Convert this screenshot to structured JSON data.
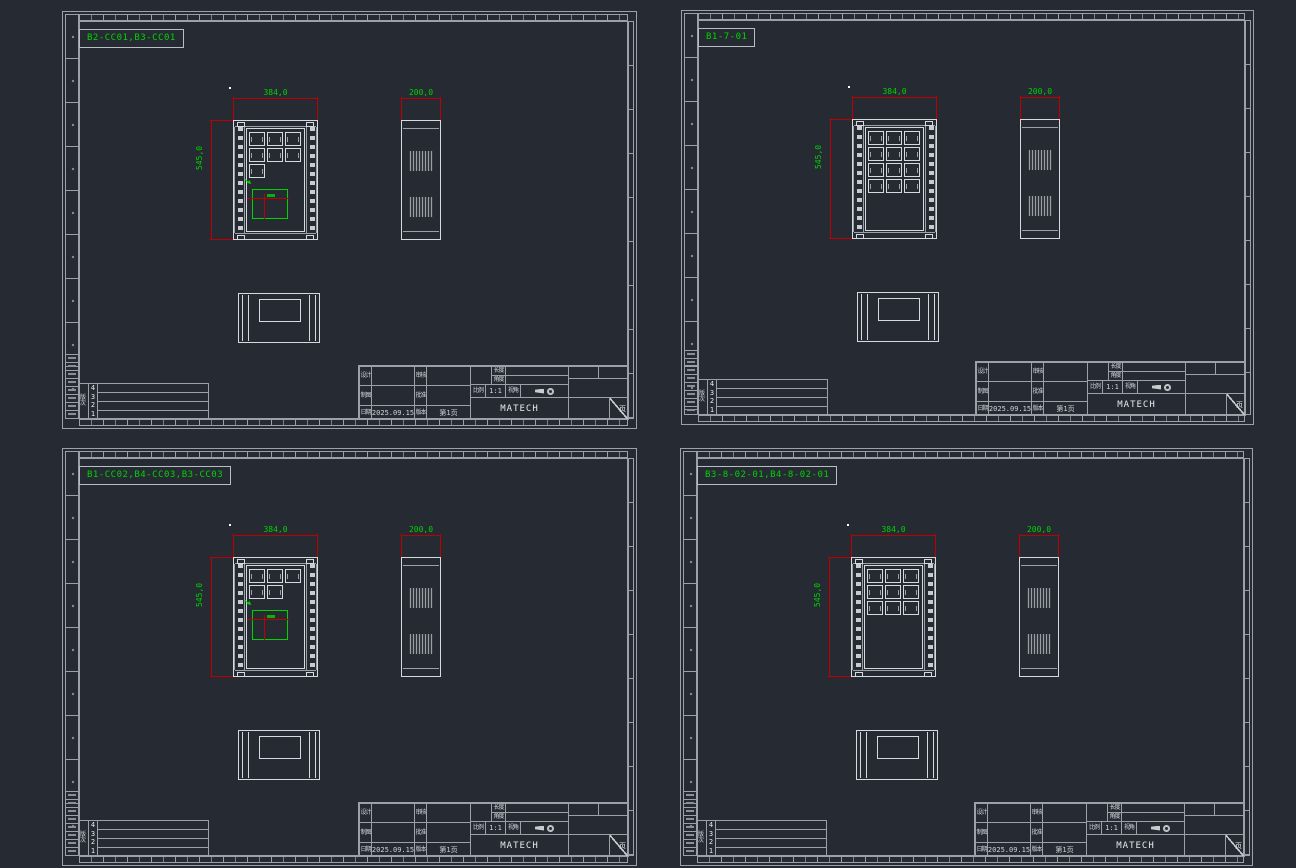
{
  "app": {
    "type": "cad-drawing-viewport",
    "colors": {
      "background": "#252a33",
      "frame_line": "#9ba1a8",
      "entity_line": "#d6dade",
      "annotation_green": "#00d400",
      "dimension_red": "#c00000"
    }
  },
  "sheets": [
    {
      "code": "B2-CC01,B3-CC01",
      "dims": {
        "front_width": "384,0",
        "front_height": "545,0",
        "side_width": "200,0"
      },
      "front": {
        "module_rows": [
          3,
          3,
          1
        ],
        "green_detail": true
      }
    },
    {
      "code": "B1-7-01",
      "dims": {
        "front_width": "384,0",
        "front_height": "545,0",
        "side_width": "200,0"
      },
      "front": {
        "module_rows": [
          3,
          3,
          3,
          3
        ],
        "green_detail": false
      }
    },
    {
      "code": "B1-CC02,B4-CC03,B3-CC03",
      "dims": {
        "front_width": "384,0",
        "front_height": "545,0",
        "side_width": "200,0"
      },
      "front": {
        "module_rows": [
          3,
          2
        ],
        "green_detail": true
      }
    },
    {
      "code": "B3-8-02-01,B4-8-02-01",
      "dims": {
        "front_width": "384,0",
        "front_height": "545,0",
        "side_width": "200,0"
      },
      "front": {
        "module_rows": [
          3,
          3,
          3
        ],
        "green_detail": false
      }
    }
  ],
  "title_block": {
    "design": "设计",
    "check": "审核",
    "draft": "制图",
    "approve": "批准",
    "date": "日期",
    "date_value": "2025.09.15",
    "version": "版本",
    "page": "第1页",
    "scale": "比例",
    "scale_value": "1:1",
    "length": "长度",
    "angle": "角度",
    "view": "视角",
    "company": "MATECH",
    "sheet_mark": "页"
  },
  "revision": {
    "label": "版次",
    "rows": [
      "4",
      "3",
      "2",
      "1"
    ]
  }
}
